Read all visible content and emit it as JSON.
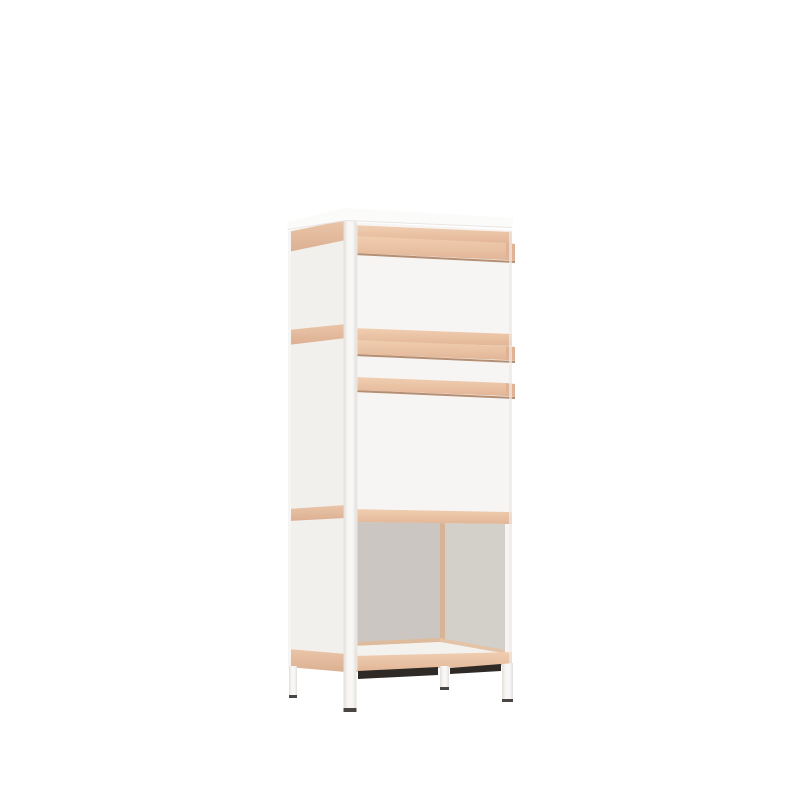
{
  "scene": {
    "description": "3D render of a tall white storage cabinet with light plywood trim: top cupboard with wooden rail handle, middle drawer and door with wooden rail handles, open lower compartment, four white legs"
  },
  "canvas": {
    "background": "#ffffff"
  },
  "colors": {
    "background": "#ffffff",
    "slab": "#fbfbfa",
    "front_panel": "#f7f5f3",
    "side_panel": "#f2f0ed",
    "side_back_edge": "#f6f5f3",
    "wood_light": "#f1ceb1",
    "wood_dark": "#e2b697",
    "wood_side_light": "#eac5a8",
    "wood_side_dark": "#dcb092",
    "wood_cap": "#dfb394",
    "rail_shadow": "#b58f74",
    "edge_line": "#e8e5e2",
    "gap_line": "#eae8e5",
    "right_edge_shade": "#eceae7",
    "interior_back": "#cbc6c1",
    "interior_side": "#d3cfc9",
    "interior_corner": "#d8b496",
    "floor": "#f4f2ef",
    "floor_edge_back": "#dfbb9e",
    "floor_edge_right": "#e5c3a6",
    "under_shadow": "#2f2a26",
    "post_light": "#f8f7f5",
    "post_edge": "#e2dfdb",
    "leg_tip": "#4a4542"
  }
}
